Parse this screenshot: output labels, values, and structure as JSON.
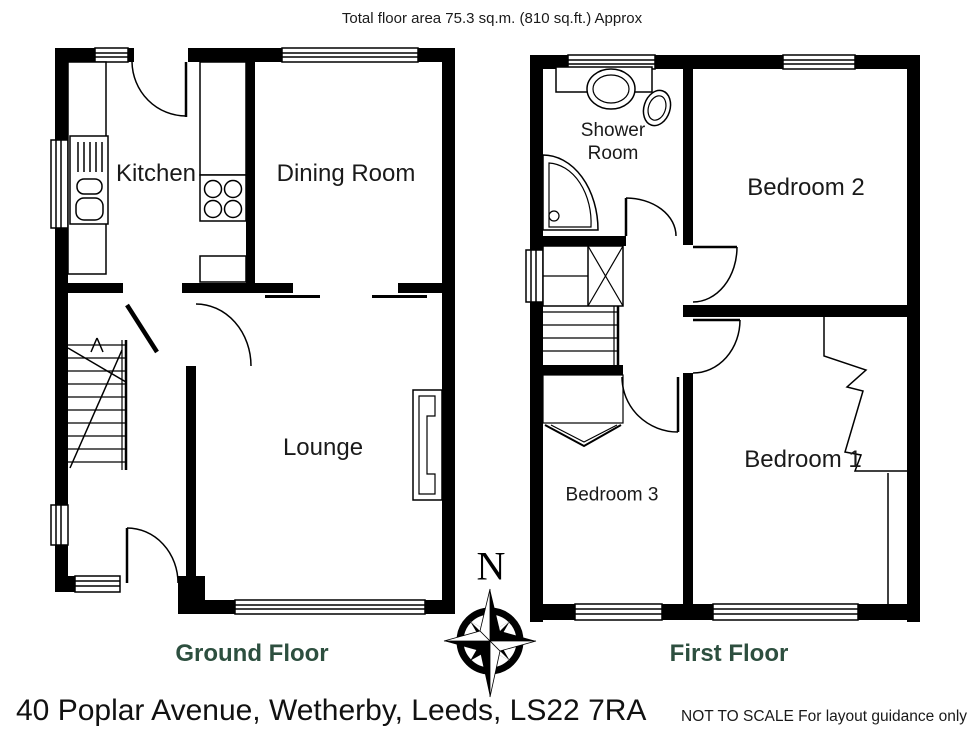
{
  "title": "Total floor area 75.3 sq.m. (810 sq.ft.) Approx",
  "address": "40 Poplar Avenue, Wetherby, Leeds, LS22 7RA",
  "disclaimer": "NOT TO SCALE For layout guidance only",
  "compass": {
    "north_label": "N"
  },
  "colors": {
    "wall": "#000000",
    "floor_label_green": "#2d4f3f",
    "text": "#1a1a1a"
  },
  "floors": [
    {
      "name": "Ground Floor",
      "rooms": [
        {
          "label": "Kitchen"
        },
        {
          "label": "Dining Room"
        },
        {
          "label": "Lounge"
        }
      ]
    },
    {
      "name": "First Floor",
      "rooms": [
        {
          "label": "Shower Room"
        },
        {
          "label": "Bedroom 2"
        },
        {
          "label": "Bedroom 1"
        },
        {
          "label": "Bedroom 3"
        }
      ]
    }
  ]
}
